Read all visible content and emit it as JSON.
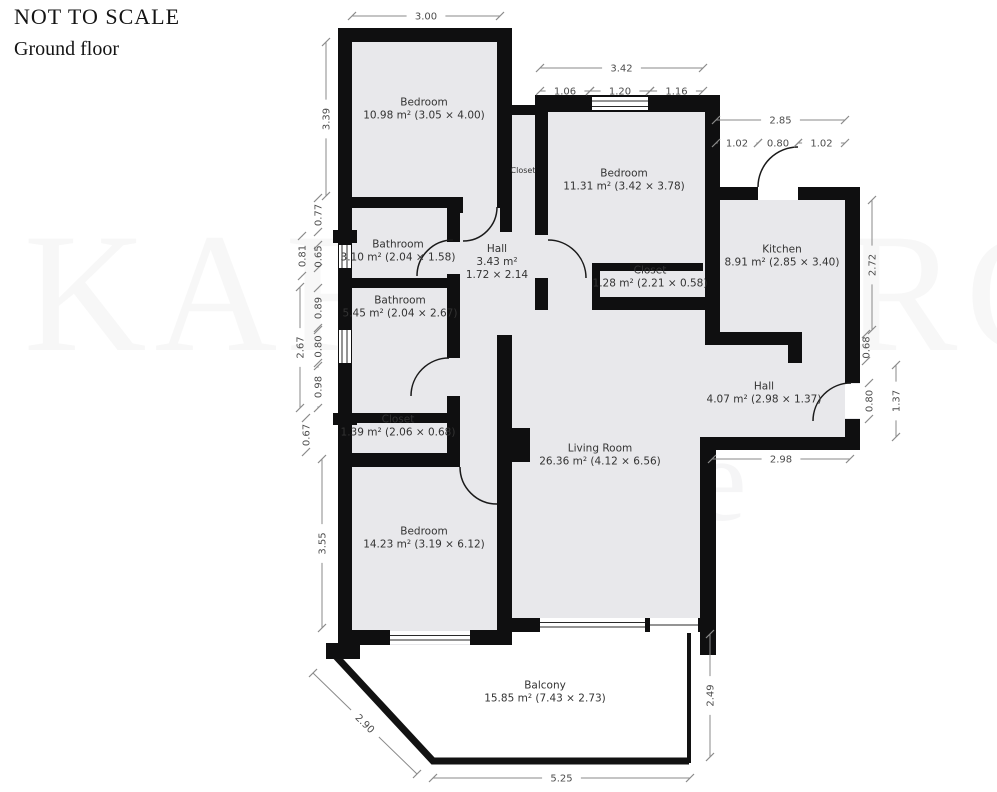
{
  "header": {
    "scale_note": "NOT TO SCALE",
    "floor_label": "Ground floor"
  },
  "watermark": {
    "line1": "KARTSBERG",
    "line2": "Estate"
  },
  "colors": {
    "wall": "#0f0f10",
    "room_fill": "#e8e8eb",
    "label": "#333333",
    "dim_text": "#4d4d4d",
    "dim_line": "#8a8a8a",
    "window_line": "#2a2a2a"
  },
  "plan": {
    "rooms": [
      {
        "id": "bedroom-top",
        "lines": [
          "Bedroom",
          "10.98 m² (3.05 × 4.00)"
        ],
        "cx": 424,
        "cy": 112
      },
      {
        "id": "closet-strip",
        "lines": [
          "Closet"
        ],
        "cx": 523,
        "cy": 173,
        "fs": 8
      },
      {
        "id": "bedroom-right",
        "lines": [
          "Bedroom",
          "11.31 m² (3.42 × 3.78)"
        ],
        "cx": 624,
        "cy": 183
      },
      {
        "id": "kitchen",
        "lines": [
          "Kitchen",
          "8.91 m² (2.85 × 3.40)"
        ],
        "cx": 782,
        "cy": 259
      },
      {
        "id": "bathroom-small",
        "lines": [
          "Bathroom",
          "3.10 m² (2.04 × 1.58)"
        ],
        "cx": 398,
        "cy": 254
      },
      {
        "id": "hall-small",
        "lines": [
          "Hall",
          "3.43 m²",
          "1.72 × 2.14"
        ],
        "cx": 497,
        "cy": 265
      },
      {
        "id": "closet-mid",
        "lines": [
          "Closet",
          "1.28 m² (2.21 × 0.58)"
        ],
        "cx": 650,
        "cy": 280
      },
      {
        "id": "bathroom-large",
        "lines": [
          "Bathroom",
          "5.45 m² (2.04 × 2.67)"
        ],
        "cx": 400,
        "cy": 310
      },
      {
        "id": "closet-left",
        "lines": [
          "Closet",
          "1.39 m² (2.06 × 0.68)"
        ],
        "cx": 398,
        "cy": 429
      },
      {
        "id": "hall-entry",
        "lines": [
          "Hall",
          "4.07 m² (2.98 × 1.37)"
        ],
        "cx": 764,
        "cy": 396
      },
      {
        "id": "living-room",
        "lines": [
          "Living Room",
          "26.36 m² (4.12 × 6.56)"
        ],
        "cx": 600,
        "cy": 458
      },
      {
        "id": "bedroom-bottom",
        "lines": [
          "Bedroom",
          "14.23 m² (3.19 × 6.12)"
        ],
        "cx": 424,
        "cy": 541
      },
      {
        "id": "balcony",
        "lines": [
          "Balcony",
          "15.85 m² (7.43 × 2.73)"
        ],
        "cx": 545,
        "cy": 695
      }
    ],
    "dims_h": [
      {
        "label": "3.00",
        "x1": 352,
        "x2": 500,
        "y": 16
      },
      {
        "label": "3.42",
        "x1": 540,
        "x2": 703,
        "y": 68
      },
      {
        "label": "1.06",
        "x1": 540,
        "x2": 590,
        "y": 91
      },
      {
        "label": "1.20",
        "x1": 590,
        "x2": 650,
        "y": 91
      },
      {
        "label": "1.16",
        "x1": 650,
        "x2": 703,
        "y": 91
      },
      {
        "label": "2.85",
        "x1": 716,
        "x2": 845,
        "y": 120
      },
      {
        "label": "1.02",
        "x1": 716,
        "x2": 758,
        "y": 143
      },
      {
        "label": "0.80",
        "x1": 758,
        "x2": 798,
        "y": 143
      },
      {
        "label": "1.02",
        "x1": 798,
        "x2": 845,
        "y": 143
      },
      {
        "label": "2.98",
        "x1": 712,
        "x2": 850,
        "y": 459
      },
      {
        "label": "5.25",
        "x1": 433,
        "x2": 690,
        "y": 778
      }
    ],
    "dims_v": [
      {
        "label": "3.39",
        "x": 326,
        "y1": 42,
        "y2": 196
      },
      {
        "label": "0.77",
        "x": 318,
        "y1": 198,
        "y2": 232
      },
      {
        "label": "0.81",
        "x": 302,
        "y1": 236,
        "y2": 276
      },
      {
        "label": "0.65",
        "x": 318,
        "y1": 245,
        "y2": 268
      },
      {
        "label": "2.67",
        "x": 300,
        "y1": 287,
        "y2": 408
      },
      {
        "label": "0.89",
        "x": 318,
        "y1": 288,
        "y2": 328
      },
      {
        "label": "0.80",
        "x": 318,
        "y1": 330,
        "y2": 363
      },
      {
        "label": "0.98",
        "x": 318,
        "y1": 366,
        "y2": 408
      },
      {
        "label": "0.67",
        "x": 306,
        "y1": 418,
        "y2": 452
      },
      {
        "label": "3.55",
        "x": 322,
        "y1": 459,
        "y2": 628
      },
      {
        "label": "2.72",
        "x": 872,
        "y1": 200,
        "y2": 330
      },
      {
        "label": "0.68",
        "x": 866,
        "y1": 334,
        "y2": 361
      },
      {
        "label": "0.80",
        "x": 869,
        "y1": 383,
        "y2": 419
      },
      {
        "label": "1.37",
        "x": 896,
        "y1": 365,
        "y2": 437
      },
      {
        "label": "2.49",
        "x": 710,
        "y1": 634,
        "y2": 757
      }
    ],
    "dims_diag": [
      {
        "label": "2.90",
        "x1": 313,
        "y1": 673,
        "x2": 417,
        "y2": 774
      }
    ]
  }
}
